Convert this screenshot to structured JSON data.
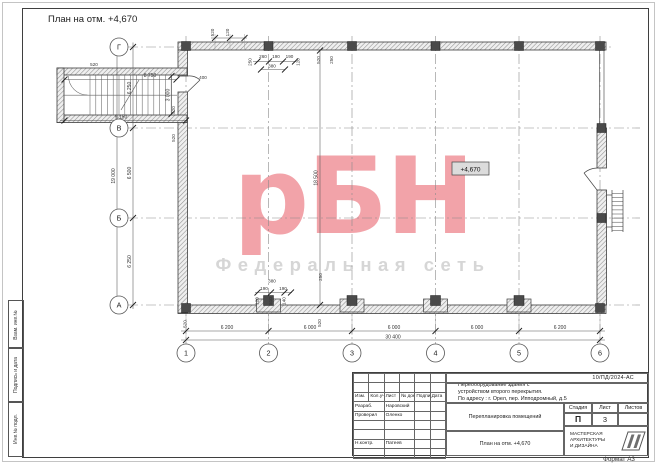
{
  "sheet": {
    "title": "План на отм. +4,670",
    "format": "Формат А3",
    "doc_number": "10/ПД/2024-АС",
    "side_fields": [
      "Взам. инв.№",
      "Подпись и дата",
      "Инв.№ подл."
    ]
  },
  "watermark": {
    "logo": "рБН",
    "tagline": "Федеральная сеть",
    "logo_color": "#f2a3a9",
    "tagline_color": "#d6d6d6"
  },
  "plan": {
    "elevation_mark": "+4,670",
    "grid_numbers": [
      "1",
      "2",
      "3",
      "4",
      "5",
      "6"
    ],
    "grid_letters": [
      "Г",
      "В",
      "Б",
      "А"
    ],
    "dims_bottom": [
      "6 200",
      "6 000",
      "6 000",
      "6 000",
      "6 200"
    ],
    "dims_bottom_total": "30 400",
    "dims_left": [
      "6 250",
      "6 500",
      "6 250"
    ],
    "dims_left_total": "19 000",
    "dim_interior": "18 500",
    "stair": {
      "width": "8 750",
      "depth": "3 000",
      "bottom_width": "9 150",
      "door": "400",
      "top": "520",
      "wall_a": "520",
      "wall_b": "520"
    },
    "micro_top": {
      "m1": "520",
      "m2": "120",
      "g2_rot": "250",
      "g2_a": "260",
      "g2_b": "190",
      "g2_c": "190",
      "g2_d": "380",
      "g2_e": "120",
      "g3_rot1": "520",
      "g3_rot2": "250"
    },
    "micro_bottom": {
      "a": "380",
      "b": "190",
      "c": "190",
      "r1": "120",
      "r2": "510",
      "r3": "140",
      "rot_250": "250",
      "w1": "520",
      "w2": "520"
    }
  },
  "title_block": {
    "columns": [
      "Изм.",
      "Кол.уч",
      "Лист",
      "№ док.",
      "Подпись",
      "Дата"
    ],
    "signers": [
      {
        "role": "Разраб.",
        "name": "Наровский"
      },
      {
        "role": "Проверил",
        "name": "Оленко"
      },
      {
        "role": "Н.контр.",
        "name": "Патеев"
      }
    ],
    "project": "Переоборудование здания с\nустройством второго перекрытия.\nПо адресу :  г. Орел, пер. Ипподромный, д.5",
    "subject": "Перепланировка помещений",
    "drawing_name": "План на отм. +4,670",
    "stage_label": "Стадия",
    "sheet_label": "Лист",
    "sheets_label": "Листов",
    "stage": "П",
    "sheet_no": "3",
    "sheets_total": "",
    "company": "МАСТЕРСКАЯ\nАРХИТЕКТУРЫ\nИ ДИЗАЙНА"
  }
}
